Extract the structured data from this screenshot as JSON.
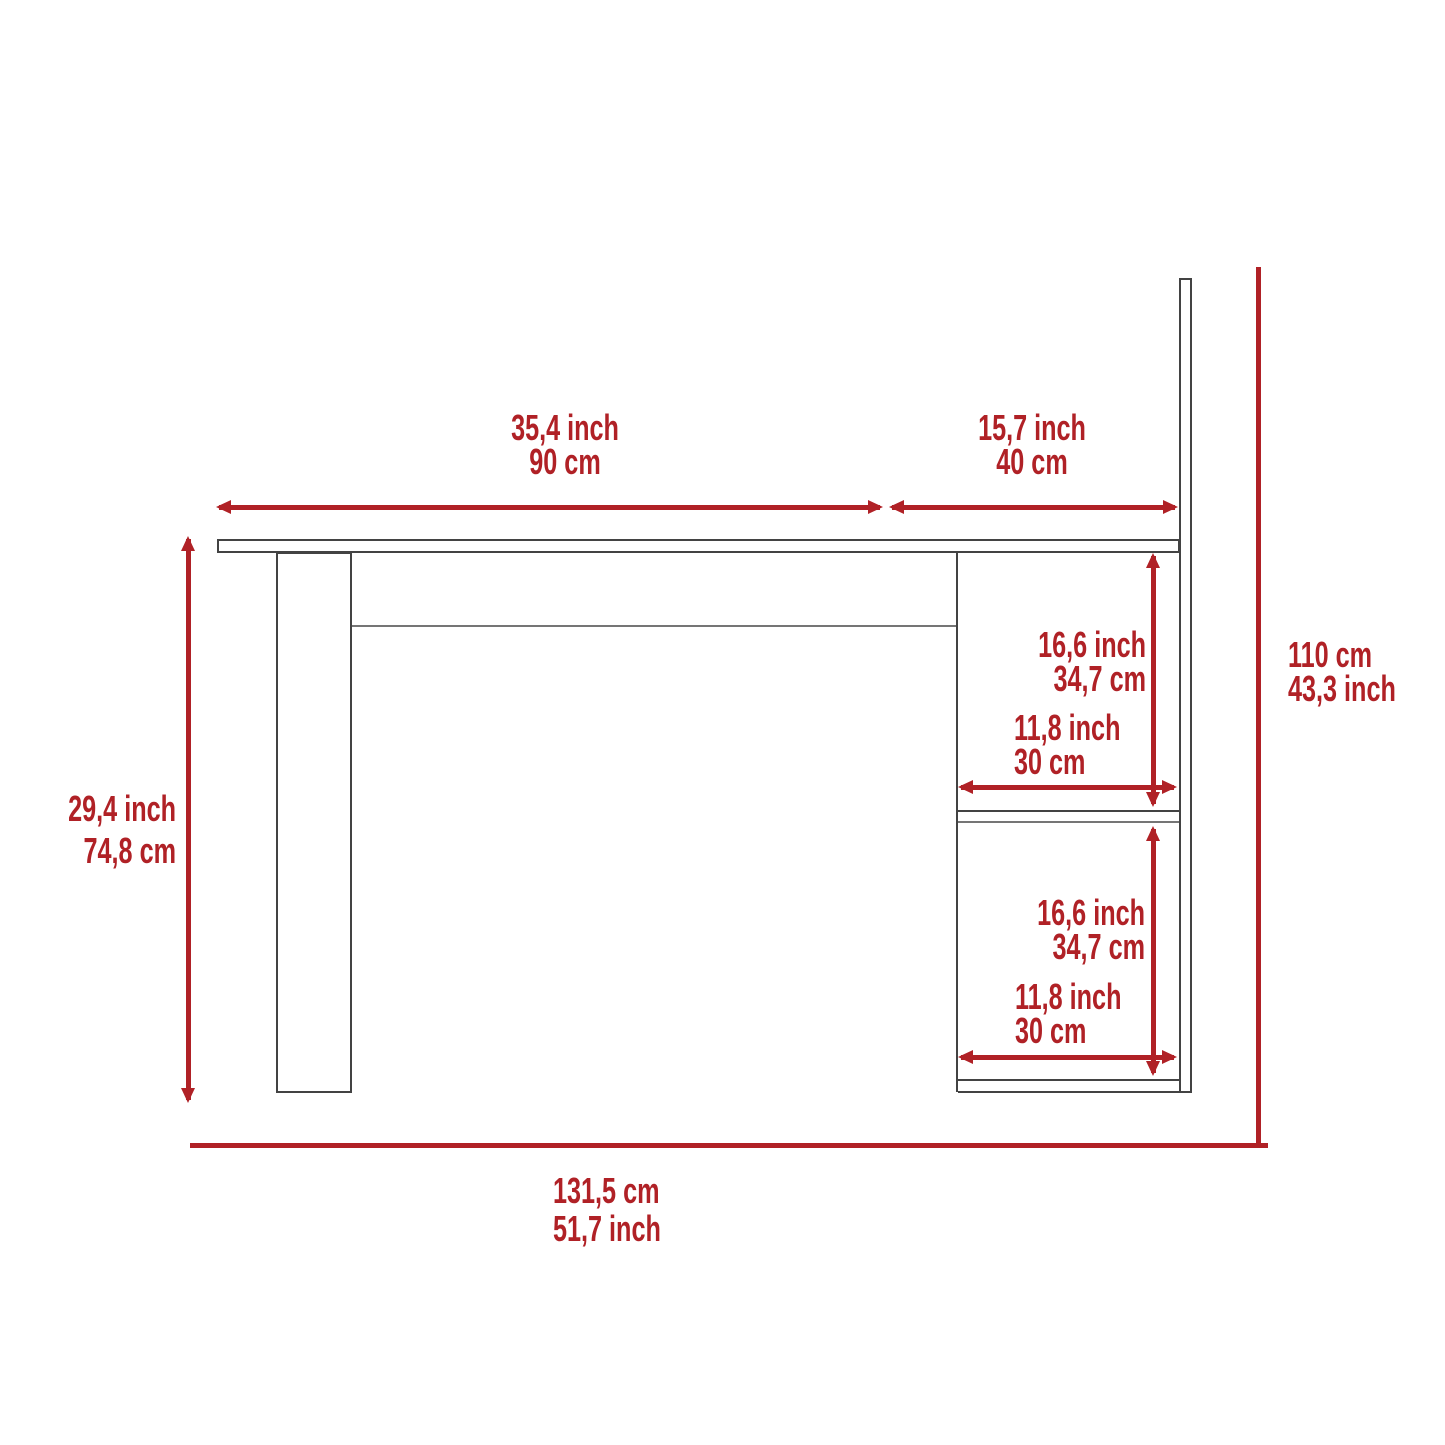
{
  "colors": {
    "accent_red": "#B02126",
    "outline_dark": "#434343",
    "outline_light": "#757575",
    "background": "#FFFFFF"
  },
  "diagram": {
    "type": "furniture-dimension-diagram",
    "subject": "desk side elevation with two-shelf tower and tall back panel",
    "labels": {
      "desktop_width": {
        "line1": "35,4 inch",
        "line2": "90 cm"
      },
      "hutch_depth": {
        "line1": "15,7 inch",
        "line2": "40 cm"
      },
      "total_height": {
        "line1": "110 cm",
        "line2": "43,3 inch"
      },
      "desk_height": {
        "line1": "29,4 inch",
        "line2": "74,8 cm"
      },
      "upper_shelf_height": {
        "line1": "16,6 inch",
        "line2": "34,7 cm"
      },
      "upper_shelf_depth": {
        "line1": "11,8 inch",
        "line2": "30 cm"
      },
      "lower_shelf_height": {
        "line1": "16,6 inch",
        "line2": "34,7 cm"
      },
      "lower_shelf_depth": {
        "line1": "11,8 inch",
        "line2": "30 cm"
      },
      "total_width": {
        "line1": "131,5 cm",
        "line2": "51,7 inch"
      }
    }
  }
}
